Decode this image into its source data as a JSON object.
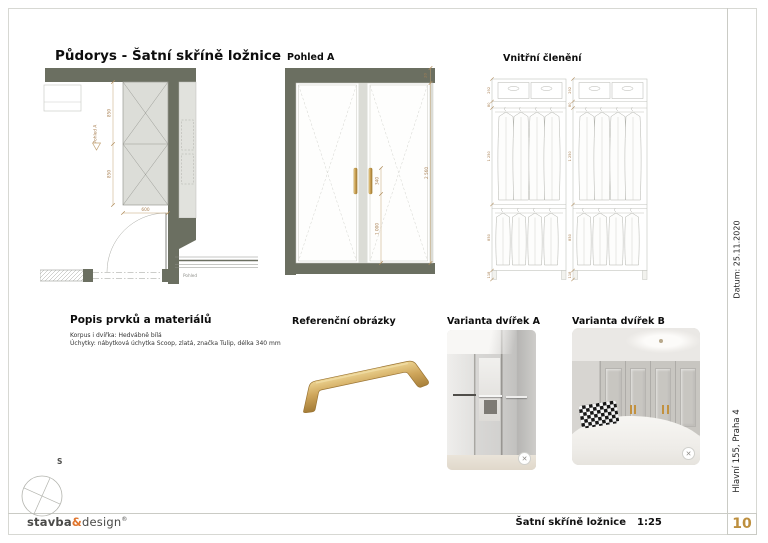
{
  "sheet": {
    "title_block": {
      "drawing_title": "Šatní skříně ložnice",
      "scale": "1:25",
      "sheet_number": "10"
    },
    "logo": {
      "bold": "stavba",
      "amp": "&",
      "light": "design",
      "reg": "®"
    },
    "side_column": {
      "date": "Datum: 25.11.2020",
      "address": "Hlavní 155, Praha 4"
    },
    "north_arrow_label": "S"
  },
  "floor_plan": {
    "title": "Půdorys - Šatní skříně ložnice",
    "dims": {
      "depth_top": "850",
      "depth_bottom": "850",
      "door_width": "600"
    },
    "view_marker": "Pohled A",
    "secondary_view_marker": "Pohled"
  },
  "elevation": {
    "title": "Pohled A",
    "dims": {
      "top_gap": "20",
      "handle_length": "340",
      "handle_height": "1 000",
      "total_height": "2 560"
    }
  },
  "interior_layout": {
    "title": "Vnitřní členění",
    "dims": [
      "292",
      "80",
      "1 250",
      "850",
      "118"
    ]
  },
  "materials": {
    "title": "Popis prvků a materiálů",
    "lines": [
      "Korpus i dvířka: Hedvábně bílá",
      "Úchytky: nábytková úchytka Scoop, zlatá, značka Tulip, délka 340 mm"
    ]
  },
  "reference": {
    "title": "Referenční obrázky"
  },
  "variant_a": {
    "title": "Varianta dvířek A",
    "badge_icon": "✕"
  },
  "variant_b": {
    "title": "Varianta dvířek B",
    "badge_icon": "✕"
  },
  "colors": {
    "wall_dark": "#6b6f61",
    "cabinet_fill": "#dcddd8",
    "dimension_tan": "#a98053",
    "handle_gold": "#c69c50",
    "logo_amp_orange": "#e0762e",
    "sheet_number_gold": "#bd8f3e"
  }
}
